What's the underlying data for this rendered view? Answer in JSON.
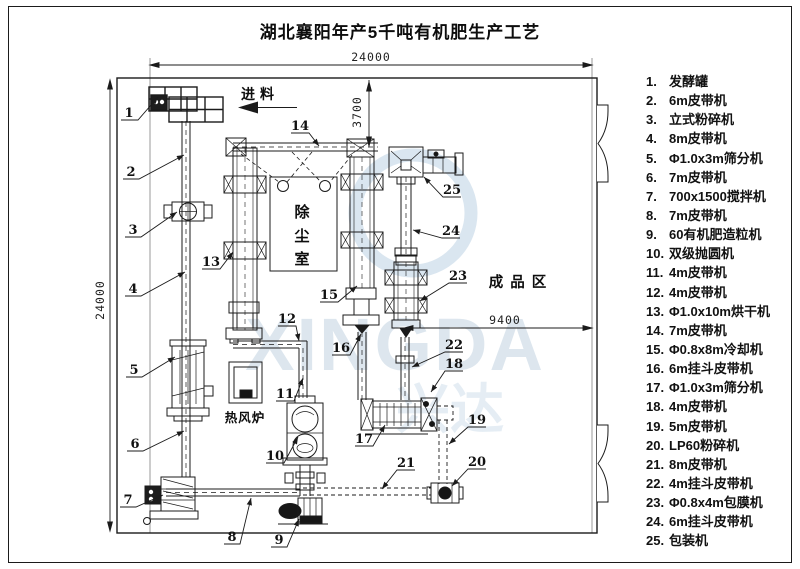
{
  "title": "湖北襄阳年产5千吨有机肥生产工艺",
  "legend": {
    "items": [
      {
        "num": "1.",
        "label": "发酵罐"
      },
      {
        "num": "2.",
        "label": "6m皮带机"
      },
      {
        "num": "3.",
        "label": "立式粉碎机"
      },
      {
        "num": "4.",
        "label": "8m皮带机"
      },
      {
        "num": "5.",
        "label": "Φ1.0x3m筛分机"
      },
      {
        "num": "6.",
        "label": "7m皮带机"
      },
      {
        "num": "7.",
        "label": "700x1500搅拌机"
      },
      {
        "num": "8.",
        "label": "7m皮带机"
      },
      {
        "num": "9.",
        "label": "60有机肥造粒机"
      },
      {
        "num": "10.",
        "label": "双级抛圆机"
      },
      {
        "num": "11.",
        "label": "4m皮带机"
      },
      {
        "num": "12.",
        "label": "4m皮带机"
      },
      {
        "num": "13.",
        "label": "Φ1.0x10m烘干机"
      },
      {
        "num": "14.",
        "label": "7m皮带机"
      },
      {
        "num": "15.",
        "label": "Φ0.8x8m冷却机"
      },
      {
        "num": "16.",
        "label": "6m挂斗皮带机"
      },
      {
        "num": "17.",
        "label": "Φ1.0x3m筛分机"
      },
      {
        "num": "18.",
        "label": "4m皮带机"
      },
      {
        "num": "19.",
        "label": "5m皮带机"
      },
      {
        "num": "20.",
        "label": "LP60粉碎机"
      },
      {
        "num": "21.",
        "label": "8m皮带机"
      },
      {
        "num": "22.",
        "label": "4m挂斗皮带机"
      },
      {
        "num": "23.",
        "label": "Φ0.8x4m包膜机"
      },
      {
        "num": "24.",
        "label": "6m挂斗皮带机"
      },
      {
        "num": "25.",
        "label": "包装机"
      }
    ]
  },
  "diagram": {
    "feed_label": "进料",
    "dust_room_chars": [
      "除",
      "尘",
      "室"
    ],
    "furnace_label": "热风炉",
    "finished_area_label": "成品区",
    "dims": {
      "top": "24000",
      "left": "24000",
      "inner_vertical": "3700",
      "inner_horizontal": "9400"
    },
    "watermark": {
      "latin": "XINGDA",
      "cjk": "兴达"
    },
    "callouts": [
      "1",
      "2",
      "3",
      "4",
      "5",
      "6",
      "7",
      "8",
      "9",
      "10",
      "11",
      "12",
      "13",
      "14",
      "15",
      "16",
      "17",
      "18",
      "19",
      "20",
      "21",
      "22",
      "23",
      "24",
      "25"
    ]
  }
}
